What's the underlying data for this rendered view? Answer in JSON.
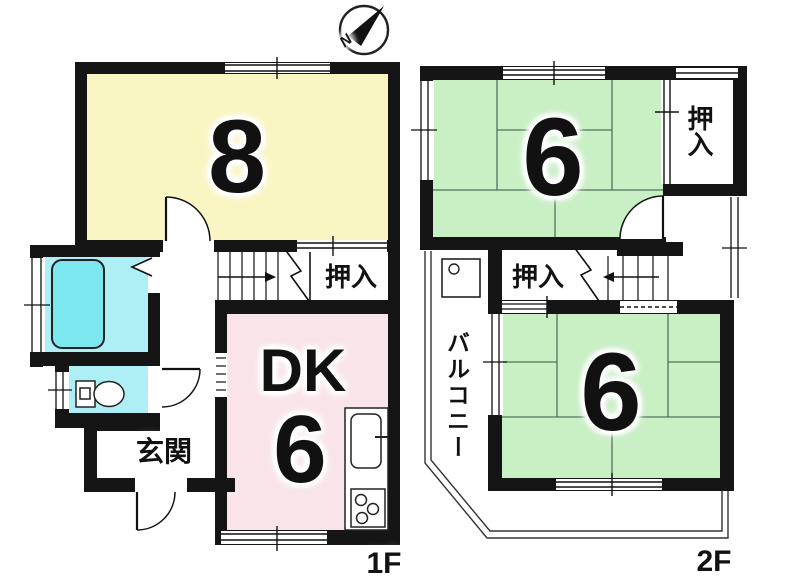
{
  "compass": {
    "north_label": "N"
  },
  "floor_1f": {
    "floor_label": "1F",
    "japanese_room": {
      "size_label": "8",
      "color": "#faf6c3"
    },
    "dining_kitchen": {
      "name_label": "DK",
      "size_label": "6",
      "color": "#f9e5e9"
    },
    "closet": {
      "label": "押入"
    },
    "entrance": {
      "label": "玄関"
    },
    "bathroom": {
      "color": "#aeeef5",
      "bathtub_color": "#7de7ef"
    },
    "fixtures": [
      "bathtub",
      "toilet",
      "kitchen-sink",
      "gas-stove",
      "staircase-up-arrow",
      "folding-door",
      "swing-doors"
    ]
  },
  "floor_2f": {
    "floor_label": "2F",
    "japanese_room_upper": {
      "size_label": "6",
      "color": "#c9efc5"
    },
    "japanese_room_lower": {
      "size_label": "6",
      "color": "#c9efc5"
    },
    "closet_upper": {
      "label": "押入"
    },
    "closet_middle": {
      "label": "押入"
    },
    "balcony": {
      "label": "バルコニー"
    },
    "fixtures": [
      "staircase-down-arrow",
      "washing-machine-pan",
      "swing-door",
      "sliding-doors"
    ]
  },
  "wall_color": "#151515"
}
